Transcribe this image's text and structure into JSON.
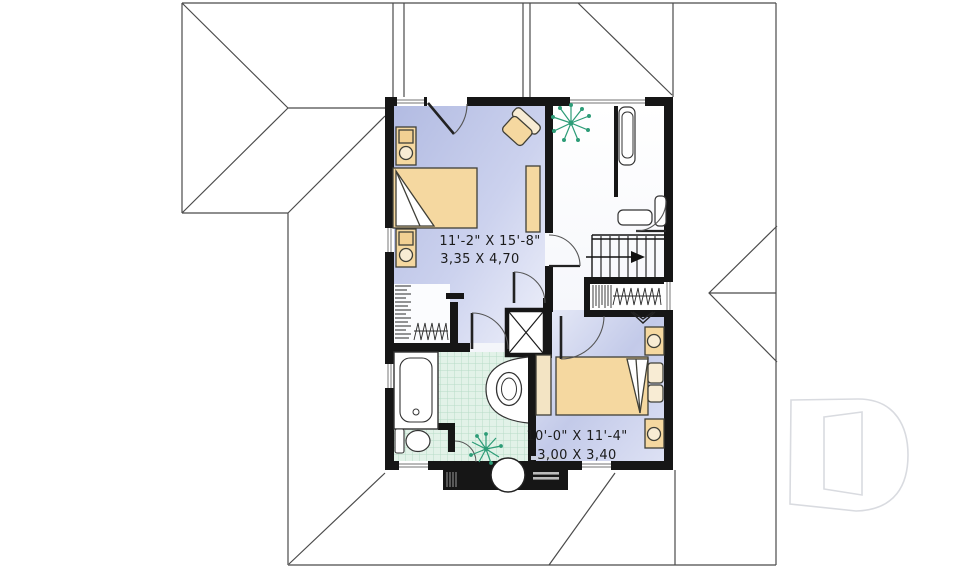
{
  "plan": {
    "bedroom1": {
      "imperial": "11'-2\" X 15'-8\"",
      "metric": "3,35 X 4,70"
    },
    "bedroom2": {
      "imperial": "10'-0\" X 11'-4\"",
      "metric": "3,00 X 3,40"
    },
    "logo_letter": "D",
    "colors": {
      "wall": "#161616",
      "floor_bedroom": "#b9c1e4",
      "floor_bedroom_light": "#eceef9",
      "floor_bath_tile": "#e2f2e8",
      "tile_line": "#b8dcc7",
      "furniture_tan": "#f5d8a0",
      "furniture_light": "#f8ecd4",
      "plant_green": "#2d9c77",
      "roof_line": "#4b4b4b",
      "window_gray": "#8f8f8f",
      "logo_outline": "#d9dbe0"
    }
  }
}
